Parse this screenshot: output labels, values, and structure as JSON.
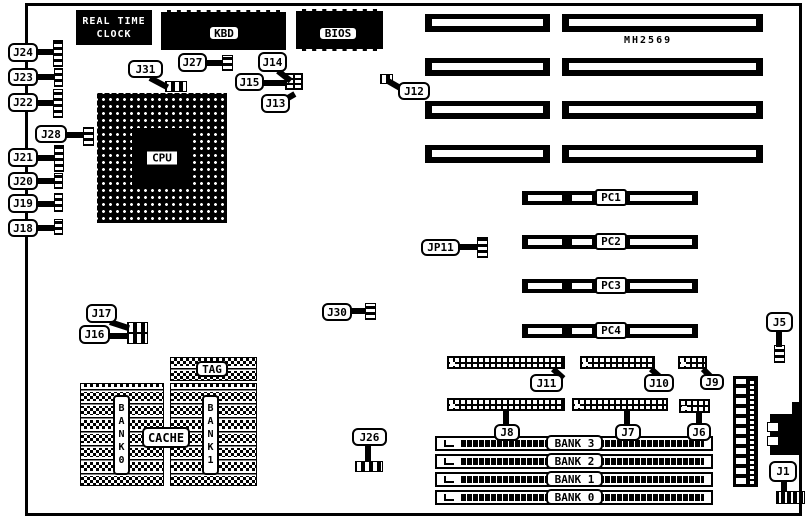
{
  "board": {
    "model": "MH2569"
  },
  "chips": {
    "rtc_line1": "REAL TIME",
    "rtc_line2": "CLOCK",
    "kbd": "KBD",
    "bios": "BIOS",
    "cpu": "CPU",
    "tag": "TAG",
    "cache": "CACHE",
    "cache_bank0": "BANK0",
    "cache_bank1": "BANK1"
  },
  "pci_slots": [
    {
      "label": "PC1"
    },
    {
      "label": "PC2"
    },
    {
      "label": "PC3"
    },
    {
      "label": "PC4"
    }
  ],
  "memory_banks": [
    {
      "label": "BANK 3"
    },
    {
      "label": "BANK 2"
    },
    {
      "label": "BANK 1"
    },
    {
      "label": "BANK 0"
    }
  ],
  "jumpers": {
    "j24": "J24",
    "j23": "J23",
    "j22": "J22",
    "j28": "J28",
    "j21": "J21",
    "j20": "J20",
    "j19": "J19",
    "j18": "J18",
    "j31": "J31",
    "j27": "J27",
    "j14": "J14",
    "j15": "J15",
    "j13": "J13",
    "j12": "J12",
    "jp11": "JP11",
    "j30": "J30",
    "j17": "J17",
    "j16": "J16",
    "j26": "J26",
    "j11": "J11",
    "j10": "J10",
    "j9": "J9",
    "j8": "J8",
    "j7": "J7",
    "j6": "J6",
    "j5": "J5",
    "j1": "J1"
  },
  "colors": {
    "ink": "#000000",
    "paper": "#ffffff"
  }
}
